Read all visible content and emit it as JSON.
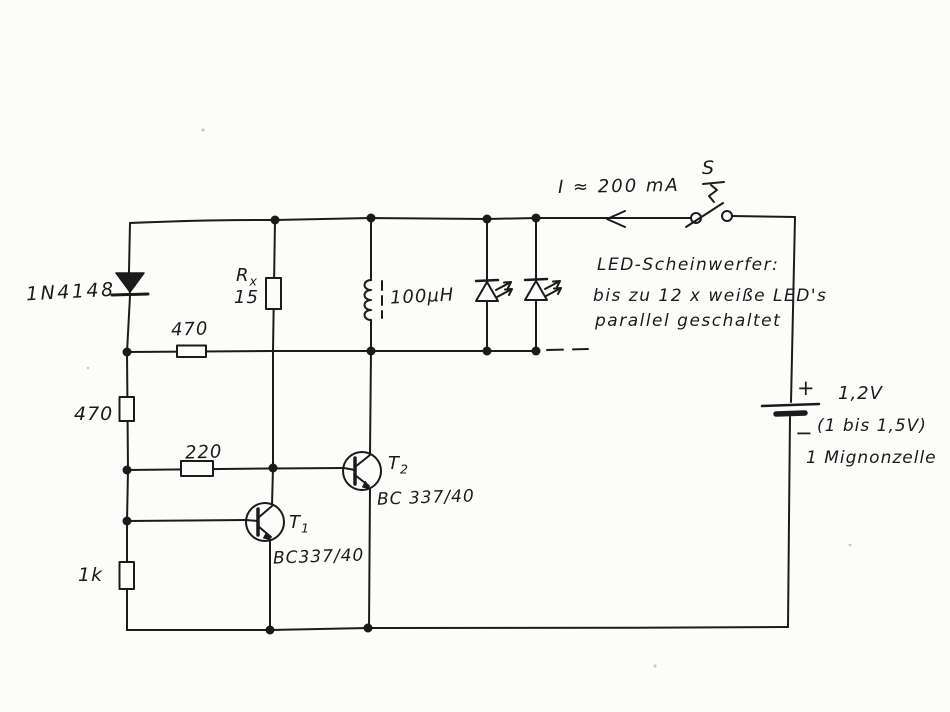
{
  "colors": {
    "ink": "#1b1b1b",
    "paper": "#fcfcfa"
  },
  "components": {
    "diode_1n4148": {
      "label": "1N4148"
    },
    "resistor_rx": {
      "name_base": "R",
      "name_sub": "x",
      "value": "15"
    },
    "resistor_470_horizontal": {
      "value": "470"
    },
    "resistor_470_vertical": {
      "value": "470"
    },
    "resistor_220": {
      "value": "220"
    },
    "resistor_1k": {
      "value": "1k"
    },
    "inductor": {
      "value": "100μH"
    },
    "transistor_t1": {
      "name_base": "T",
      "name_sub": "1",
      "part": "BC337/40"
    },
    "transistor_t2": {
      "name_base": "T",
      "name_sub": "2",
      "part": "BC 337/40"
    },
    "switch": {
      "label": "S"
    },
    "battery": {
      "plus": "+",
      "minus": "−",
      "voltage": "1,2V",
      "range": "(1 bis 1,5V)",
      "cell": "1 Mignonzelle"
    }
  },
  "annotations": {
    "current": "I ≈ 200 mA",
    "note_line1": "LED-Scheinwerfer:",
    "note_line2": "bis zu 12 x weiße LED's",
    "note_line3": "parallel geschaltet"
  }
}
